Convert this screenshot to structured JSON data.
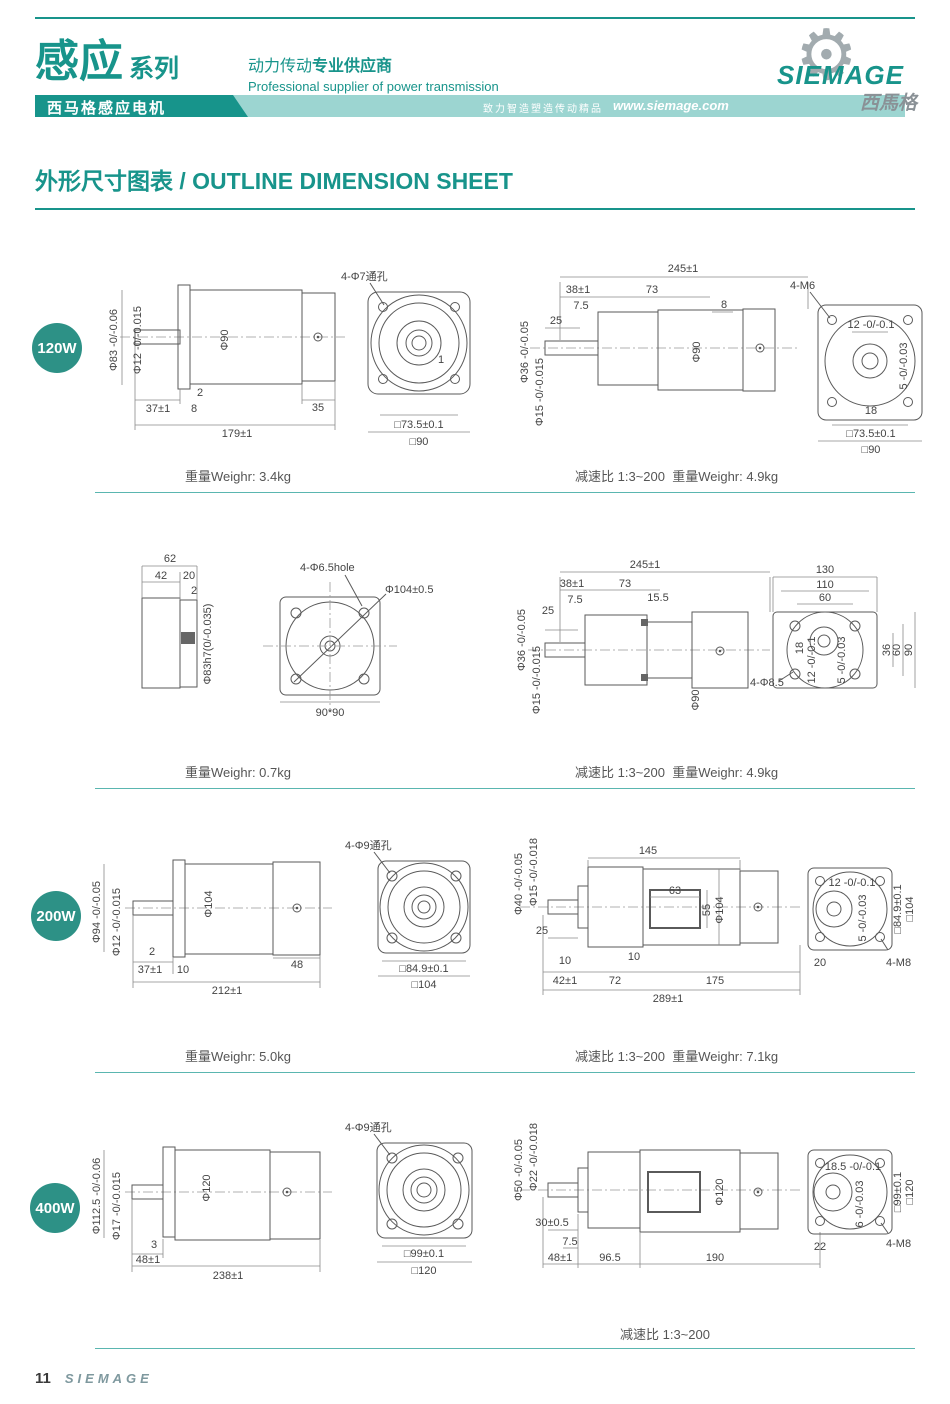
{
  "header": {
    "series_title": "感应",
    "series_suffix": "系列",
    "tagline_cn_regular": "动力传动",
    "tagline_cn_bold": "专业供应商",
    "tagline_en": "Professional supplier of power transmission",
    "band_product": "西马格感应电机",
    "band_slogan": "致力智造塑造传动精品",
    "band_url": "www.siemage.com",
    "gear_glyph": "⚙",
    "logo_name": "SIEMAGE",
    "logo_cn": "西馬格"
  },
  "title": "外形尺寸图表 / OUTLINE DIMENSION SHEET",
  "colors": {
    "teal": "#18948b",
    "teal_light": "#9cd5d1",
    "badge": "#2d9186",
    "caption_line": "#5ab6b0",
    "drawing_line": "#5a5a5a"
  },
  "sections": [
    {
      "badge": "120W",
      "captions": {
        "left": "重量Weighr: 3.4kg",
        "right": "减速比 1:3~200  重量Weighr: 4.9kg"
      },
      "views": {
        "motor_side": {
          "labels": [
            "Φ83 -0/-0.06",
            "Φ12 -0/-0.015",
            "Φ90",
            "2",
            "37±1",
            "8",
            "35",
            "179±1"
          ]
        },
        "motor_front": {
          "labels": [
            "4-Φ7通孔",
            "1",
            "□73.5±0.1",
            "□90"
          ]
        },
        "gear_side": {
          "labels": [
            "245±1",
            "38±1",
            "73",
            "7.5",
            "8",
            "25",
            "Φ36 -0/-0.05",
            "Φ15 -0/-0.015",
            "Φ90"
          ]
        },
        "gear_rear": {
          "labels": [
            "4-M6",
            "12 -0/-0.1",
            "5 -0/-0.03",
            "18",
            "□73.5±0.1",
            "□90"
          ]
        }
      }
    },
    {
      "captions": {
        "left": "重量Weighr: 0.7kg",
        "right": "减速比 1:3~200  重量Weighr: 4.9kg"
      },
      "views": {
        "motor_side": {
          "labels": [
            "62",
            "42",
            "20",
            "2",
            "Φ83h7(0/-0.035)"
          ]
        },
        "motor_front": {
          "labels": [
            "4-Φ6.5hole",
            "Φ104±0.5",
            "90*90"
          ]
        },
        "gear_side": {
          "labels": [
            "245±1",
            "38±1",
            "73",
            "7.5",
            "15.5",
            "25",
            "Φ36 -0/-0.05",
            "Φ15 -0/-0.015",
            "Φ90"
          ]
        },
        "gear_rear": {
          "labels": [
            "130",
            "110",
            "60",
            "18",
            "12 -0/-0.1",
            "5 -0/-0.03",
            "36",
            "60",
            "90",
            "4-Φ8.5"
          ]
        }
      }
    },
    {
      "badge": "200W",
      "captions": {
        "left": "重量Weighr: 5.0kg",
        "right": "减速比 1:3~200  重量Weighr: 7.1kg"
      },
      "views": {
        "motor_side": {
          "labels": [
            "Φ94 -0/-0.05",
            "Φ12 -0/-0.015",
            "Φ104",
            "2",
            "37±1",
            "10",
            "48",
            "212±1"
          ]
        },
        "motor_front": {
          "labels": [
            "4-Φ9通孔",
            "□84.9±0.1",
            "□104"
          ]
        },
        "gear_side": {
          "labels": [
            "Φ40 -0/-0.05",
            "Φ15 -0/-0.018",
            "145",
            "63",
            "55",
            "Φ104",
            "25",
            "10",
            "42±1",
            "72",
            "10",
            "175",
            "289±1"
          ]
        },
        "gear_rear": {
          "labels": [
            "12 -0/-0.1",
            "5 -0/-0.03",
            "□84.9±0.1",
            "□104",
            "20",
            "4-M8"
          ]
        }
      }
    },
    {
      "badge": "400W",
      "captions": {
        "right": "减速比 1:3~200"
      },
      "views": {
        "motor_side": {
          "labels": [
            "Φ112.5 -0/-0.06",
            "Φ17 -0/-0.015",
            "Φ120",
            "3",
            "48±1",
            "238±1"
          ]
        },
        "motor_front": {
          "labels": [
            "4-Φ9通孔",
            "□99±0.1",
            "□120"
          ]
        },
        "gear_side": {
          "labels": [
            "Φ50 -0/-0.05",
            "Φ22 -0/-0.018",
            "30±0.5",
            "7.5",
            "48±1",
            "96.5",
            "190",
            "Φ120"
          ]
        },
        "gear_rear": {
          "labels": [
            "18.5 -0/-0.1",
            "6 -0/-0.03",
            "□99±0.1",
            "□120",
            "22",
            "4-M8"
          ]
        }
      }
    }
  ],
  "footer": {
    "page": "11",
    "brand": "SIEMAGE"
  }
}
